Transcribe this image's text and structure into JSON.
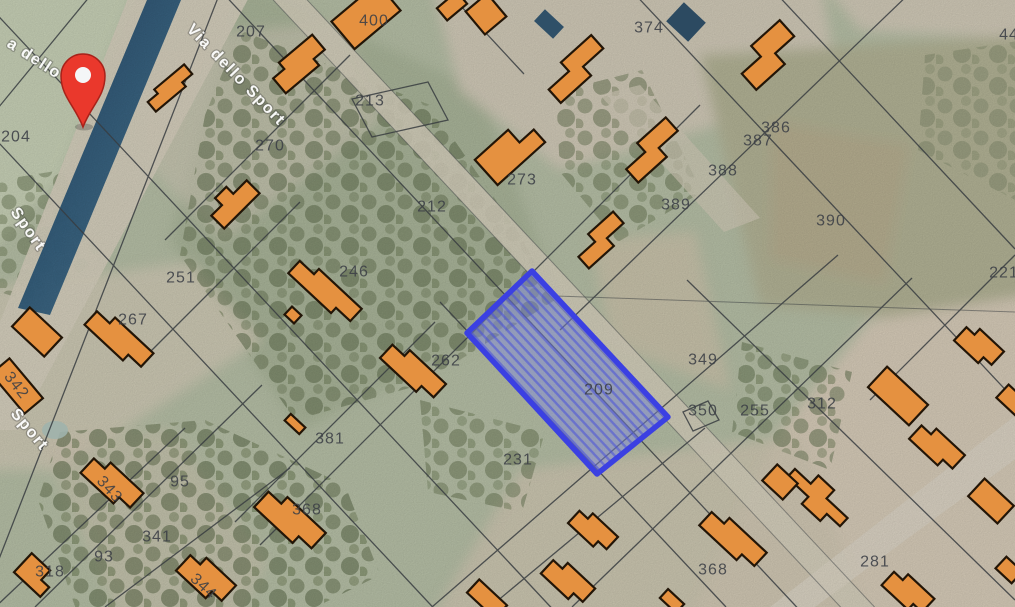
{
  "map": {
    "type": "satellite-cadastral-view",
    "street_name": "Via dello Sport",
    "selected_parcel_id": "209",
    "street_labels": [
      {
        "text": "a dello Spo",
        "x": 6,
        "y": 46,
        "rotate": 33
      },
      {
        "text": "Via dello Sport",
        "x": 186,
        "y": 30,
        "rotate": 46
      },
      {
        "text": "Sport",
        "x": 10,
        "y": 212,
        "rotate": 55
      },
      {
        "text": "Sport",
        "x": 10,
        "y": 414,
        "rotate": 50
      }
    ],
    "parcel_labels": [
      {
        "text": "204",
        "x": 16,
        "y": 136
      },
      {
        "text": "207",
        "x": 251,
        "y": 31
      },
      {
        "text": "400",
        "x": 374,
        "y": 20
      },
      {
        "text": "374",
        "x": 649,
        "y": 27
      },
      {
        "text": "44",
        "x": 1009,
        "y": 34,
        "faint": true
      },
      {
        "text": "213",
        "x": 370,
        "y": 100
      },
      {
        "text": "270",
        "x": 270,
        "y": 145
      },
      {
        "text": "386",
        "x": 776,
        "y": 127
      },
      {
        "text": "387",
        "x": 758,
        "y": 140
      },
      {
        "text": "388",
        "x": 723,
        "y": 170
      },
      {
        "text": "273",
        "x": 522,
        "y": 179
      },
      {
        "text": "389",
        "x": 676,
        "y": 204
      },
      {
        "text": "212",
        "x": 432,
        "y": 206
      },
      {
        "text": "390",
        "x": 831,
        "y": 220
      },
      {
        "text": "221",
        "x": 1004,
        "y": 272
      },
      {
        "text": "246",
        "x": 354,
        "y": 271
      },
      {
        "text": "251",
        "x": 181,
        "y": 277
      },
      {
        "text": "267",
        "x": 133,
        "y": 319
      },
      {
        "text": "262",
        "x": 446,
        "y": 360
      },
      {
        "text": "349",
        "x": 703,
        "y": 359
      },
      {
        "text": "209",
        "x": 599,
        "y": 389
      },
      {
        "text": "312",
        "x": 822,
        "y": 403
      },
      {
        "text": "350",
        "x": 703,
        "y": 410
      },
      {
        "text": "255",
        "x": 755,
        "y": 410
      },
      {
        "text": "342",
        "x": 17,
        "y": 385,
        "rotate": 52
      },
      {
        "text": "231",
        "x": 518,
        "y": 459
      },
      {
        "text": "381",
        "x": 330,
        "y": 438
      },
      {
        "text": "95",
        "x": 180,
        "y": 481
      },
      {
        "text": "343",
        "x": 110,
        "y": 489,
        "rotate": 48
      },
      {
        "text": "368",
        "x": 307,
        "y": 509
      },
      {
        "text": "341",
        "x": 157,
        "y": 536
      },
      {
        "text": "93",
        "x": 104,
        "y": 556
      },
      {
        "text": "318",
        "x": 50,
        "y": 571
      },
      {
        "text": "281",
        "x": 875,
        "y": 561
      },
      {
        "text": "368",
        "x": 713,
        "y": 569
      },
      {
        "text": "344",
        "x": 204,
        "y": 586,
        "rotate": 43
      }
    ],
    "colors": {
      "building": "#e59140",
      "building_outline": "#221507",
      "selected_fill": "#7b84ea",
      "selected_border": "#3b40e2",
      "marker_red": "#ea382c",
      "road_strip_navy": "#1c3a5c"
    }
  }
}
